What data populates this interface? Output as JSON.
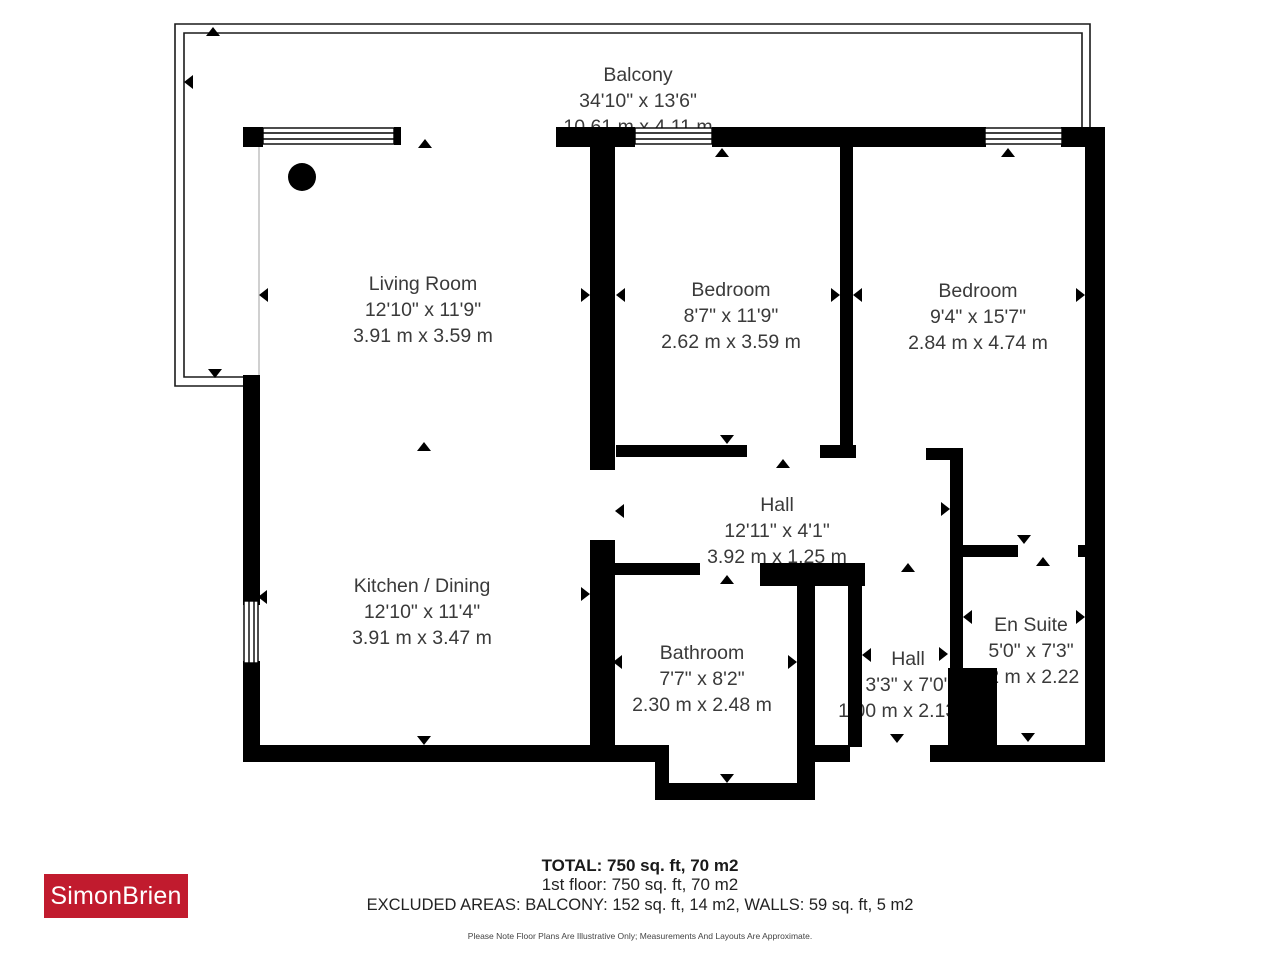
{
  "branding": {
    "logo_text": "SimonBrien",
    "logo_color": "#c11b2e",
    "logo_text_color": "#ffffff"
  },
  "colors": {
    "wall": "#000000",
    "label_text": "#3a3a3a",
    "background": "#ffffff"
  },
  "rooms": {
    "balcony": {
      "name": "Balcony",
      "imperial": "34'10\" x 13'6\"",
      "metric": "10.61 m x 4.11 m"
    },
    "living_room": {
      "name": "Living Room",
      "imperial": "12'10\" x 11'9\"",
      "metric": "3.91 m x 3.59 m"
    },
    "bedroom_1": {
      "name": "Bedroom",
      "imperial": "8'7\" x 11'9\"",
      "metric": "2.62 m x 3.59 m"
    },
    "bedroom_2": {
      "name": "Bedroom",
      "imperial": "9'4\" x 15'7\"",
      "metric": "2.84 m x 4.74 m"
    },
    "hall": {
      "name": "Hall",
      "imperial": "12'11\" x 4'1\"",
      "metric": "3.92 m x 1.25 m"
    },
    "kitchen_dining": {
      "name": "Kitchen / Dining",
      "imperial": "12'10\" x 11'4\"",
      "metric": "3.91 m x 3.47 m"
    },
    "bathroom": {
      "name": "Bathroom",
      "imperial": "7'7\" x 8'2\"",
      "metric": "2.30 m x 2.48 m"
    },
    "hall_2": {
      "name": "Hall",
      "imperial": "3'3\" x 7'0\"",
      "metric": "1.00 m x 2.13 m"
    },
    "en_suite": {
      "name": "En Suite",
      "imperial": "5'0\" x 7'3\"",
      "metric": "1.52 m x 2.22 m"
    }
  },
  "footer": {
    "total": "TOTAL: 750 sq. ft, 70 m2",
    "floor": "1st floor: 750 sq. ft, 70 m2",
    "excluded": "EXCLUDED AREAS: BALCONY: 152 sq. ft, 14 m2, WALLS: 59 sq. ft, 5 m2",
    "disclaimer": "Please Note Floor Plans Are Illustrative Only; Measurements And Layouts Are Approximate."
  }
}
